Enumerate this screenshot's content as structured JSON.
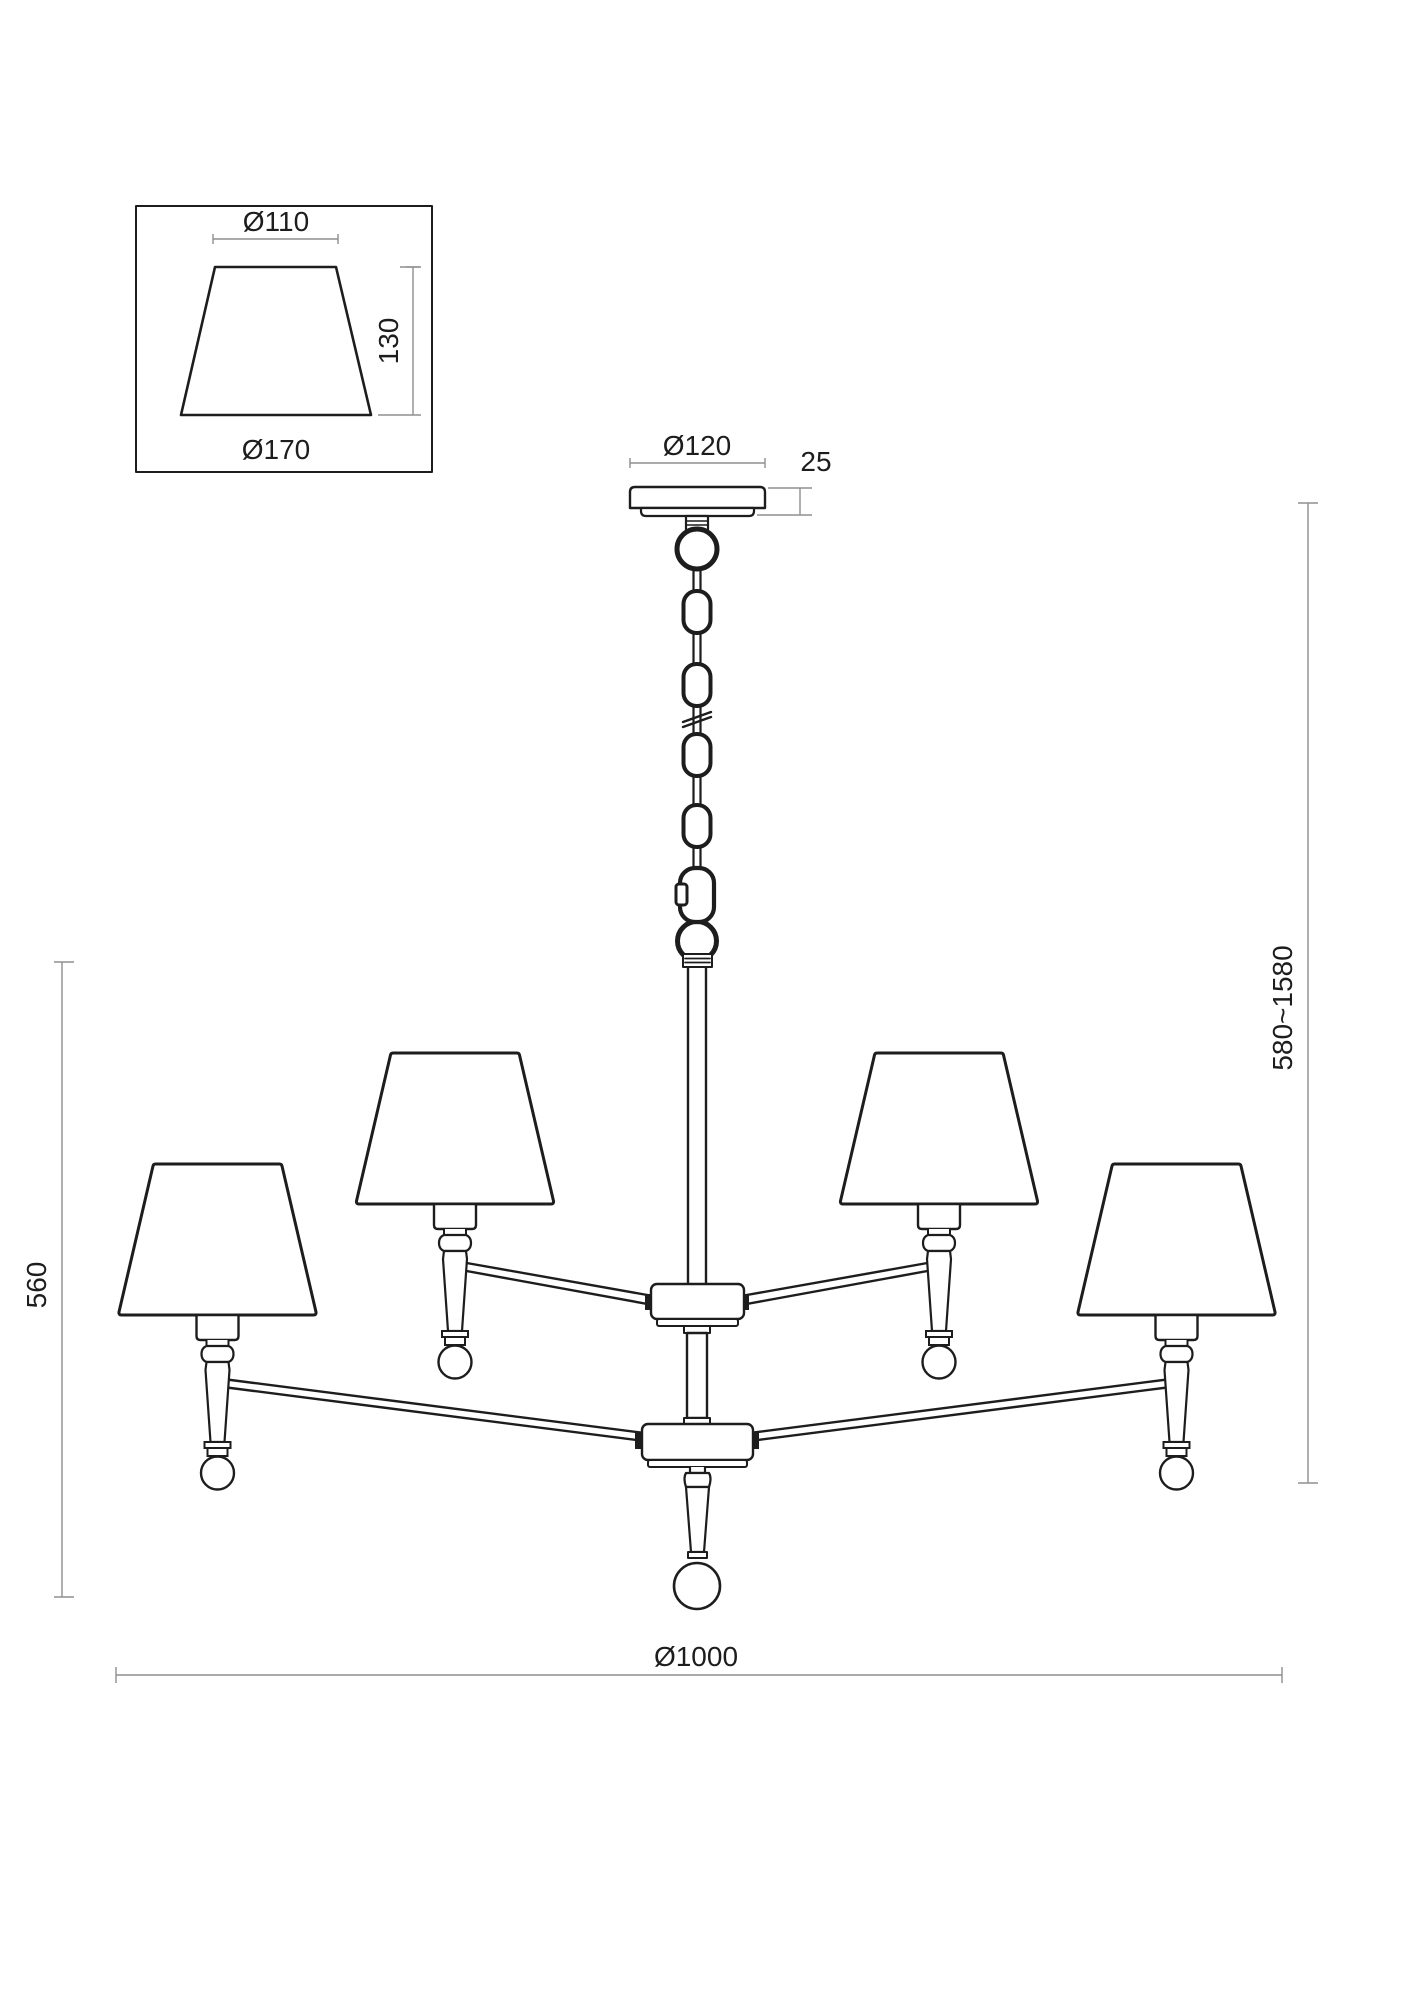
{
  "drawing": {
    "title": "chandelier-dimension-drawing",
    "colors": {
      "background": "#ffffff",
      "line": "#1d1d1d",
      "dimension_line": "#8f8f8f"
    },
    "shade_detail": {
      "top_diameter": "Ø110",
      "height": "130",
      "bottom_diameter": "Ø170"
    },
    "canopy": {
      "diameter": "Ø120",
      "thickness": "25"
    },
    "overall": {
      "body_height": "560",
      "suspension_height": "580~1580",
      "spread_diameter": "Ø1000"
    }
  }
}
